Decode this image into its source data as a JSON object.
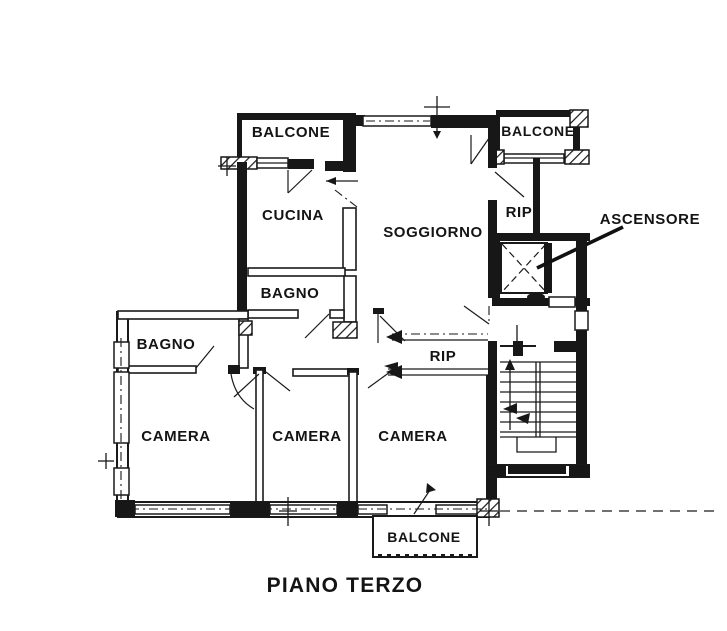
{
  "labels": {
    "balcone_top_left": "BALCONE",
    "balcone_top_right": "BALCONE",
    "balcone_bottom": "BALCONE",
    "cucina": "CUCINA",
    "soggiorno": "SOGGIORNO",
    "rip_top": "RIP",
    "rip_hall": "RIP",
    "bagno_upper": "BAGNO",
    "bagno_left": "BAGNO",
    "camera_left": "CAMERA",
    "camera_center": "CAMERA",
    "camera_right": "CAMERA",
    "ascensore": "ASCENSORE",
    "floor_title": "PIANO TERZO"
  },
  "colors": {
    "line": "#1a1a1a",
    "background": "#ffffff"
  }
}
